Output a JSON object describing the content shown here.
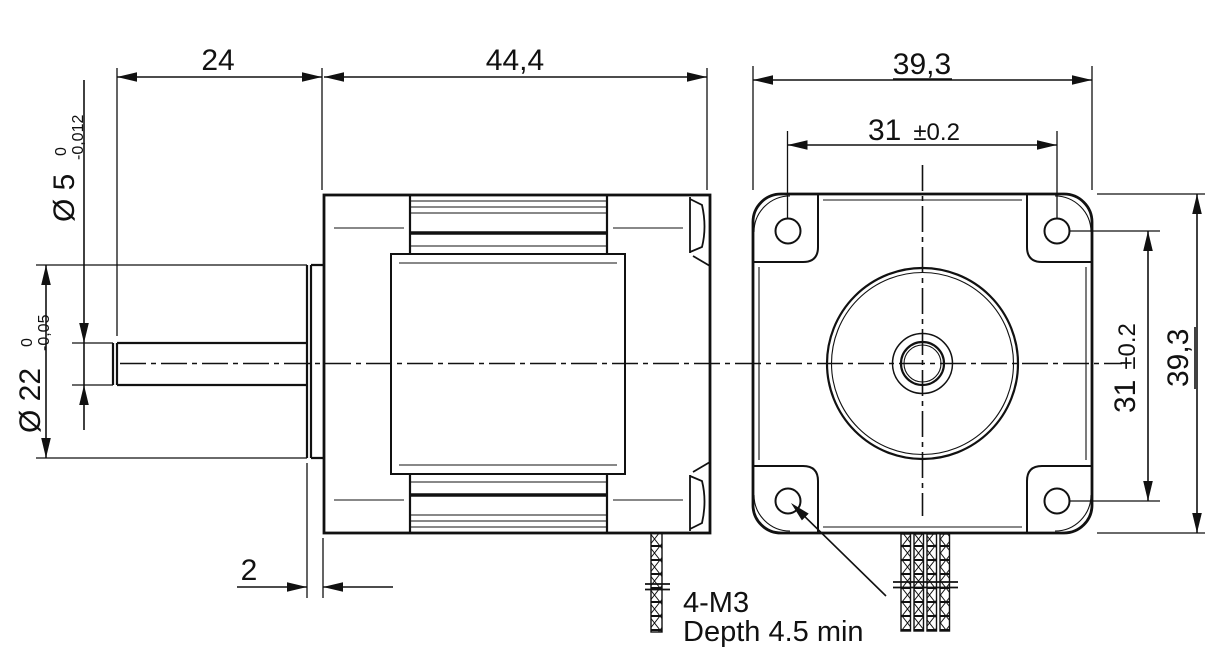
{
  "drawing": {
    "background": "#ffffff",
    "line_color": "#111111",
    "side_view": {
      "dim_shaft_length": "24",
      "dim_body_length": "44,4",
      "dim_shaft_diameter": "Ø 5",
      "shaft_tol_upper": "0",
      "shaft_tol_lower": "-0,012",
      "dim_pilot_diameter": "Ø 22",
      "pilot_tol_upper": "0",
      "pilot_tol_lower": "-0,05",
      "dim_pilot_depth": "2"
    },
    "front_view": {
      "dim_overall_width": "39,3",
      "dim_overall_height": "39,3",
      "hole_spacing_h": "31",
      "hole_spacing_h_tol": "±0.2",
      "hole_spacing_v": "31",
      "hole_spacing_v_tol": "±0.2",
      "mounting_note_line1": "4-M3",
      "mounting_note_line2": "Depth 4.5 min"
    }
  }
}
